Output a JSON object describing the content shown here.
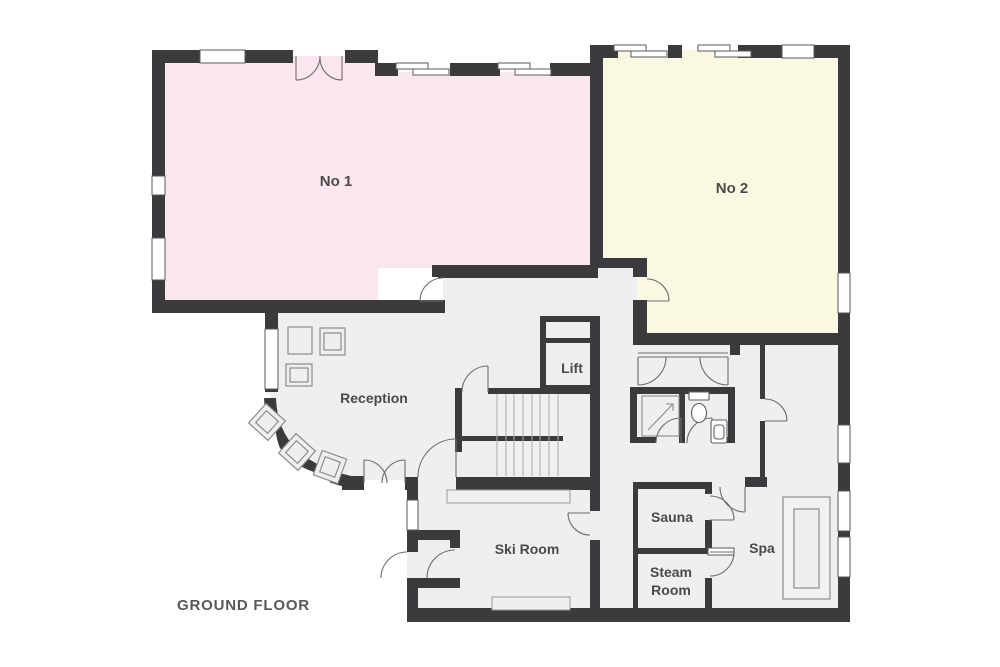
{
  "title": "GROUND FLOOR",
  "rooms": {
    "no1": {
      "label": "No 1"
    },
    "no2": {
      "label": "No 2"
    },
    "reception": {
      "label": "Reception"
    },
    "lift": {
      "label": "Lift"
    },
    "ski_room": {
      "label": "Ski Room"
    },
    "sauna": {
      "label": "Sauna"
    },
    "steam_room": {
      "label": "Steam Room",
      "line1": "Steam",
      "line2": "Room"
    },
    "spa": {
      "label": "Spa"
    }
  },
  "colors": {
    "background": "#FFFFFF",
    "wall": "#3B3B3D",
    "room_gray": "#EFEFEF",
    "no1_pink": "#F9E6EE",
    "no2_yellow": "#FBF8E1",
    "door_line": "#6E6E6E",
    "fixture_line": "#8C8C8C",
    "fixture_dark": "#5F5F61",
    "text": "#4A4A4D"
  }
}
